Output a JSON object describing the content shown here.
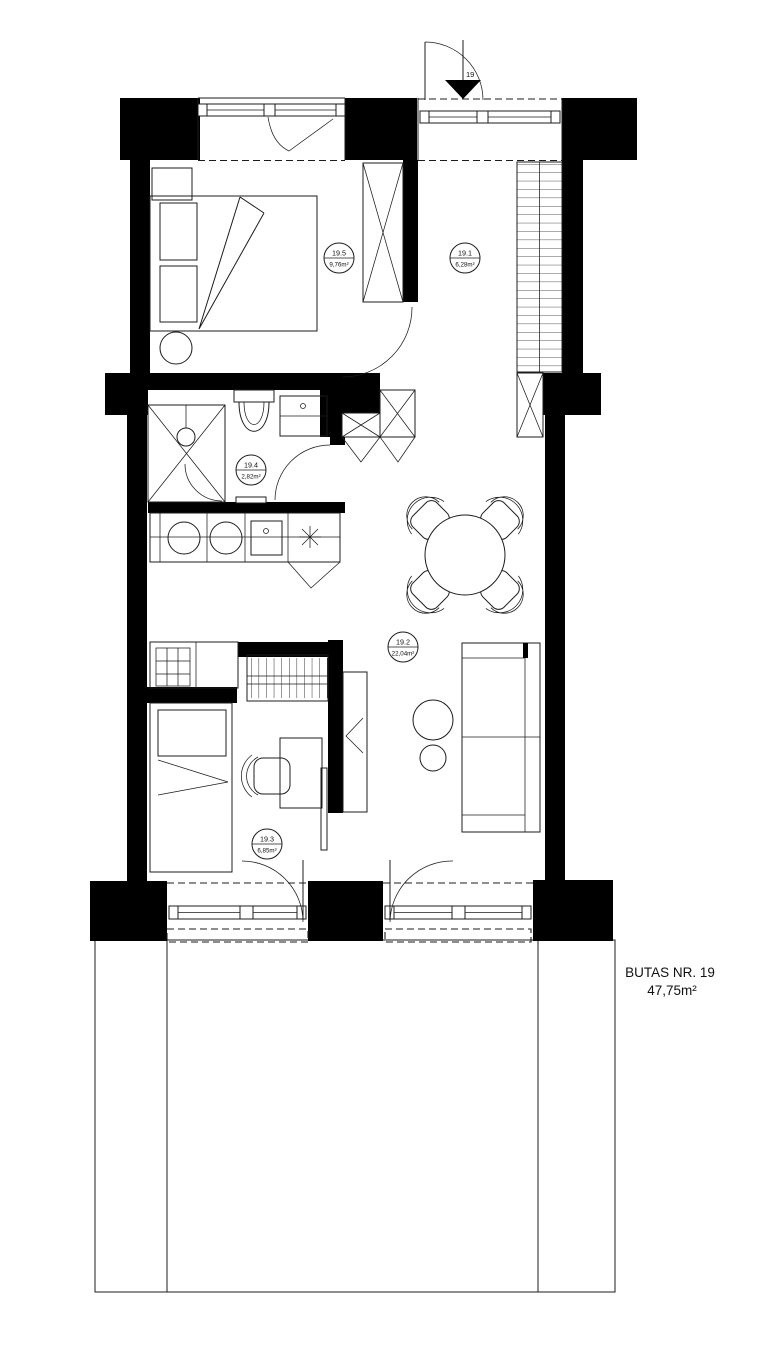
{
  "plan": {
    "title_line1": "BUTAS NR. 19",
    "title_line2": "47,75m²",
    "entrance_label": "19",
    "rooms": [
      {
        "id": "19.1",
        "area": "6,28m²"
      },
      {
        "id": "19.2",
        "area": "22,04m²"
      },
      {
        "id": "19.3",
        "area": "6,85m²"
      },
      {
        "id": "19.4",
        "area": "2,82m²"
      },
      {
        "id": "19.5",
        "area": "9,76m²"
      }
    ]
  }
}
